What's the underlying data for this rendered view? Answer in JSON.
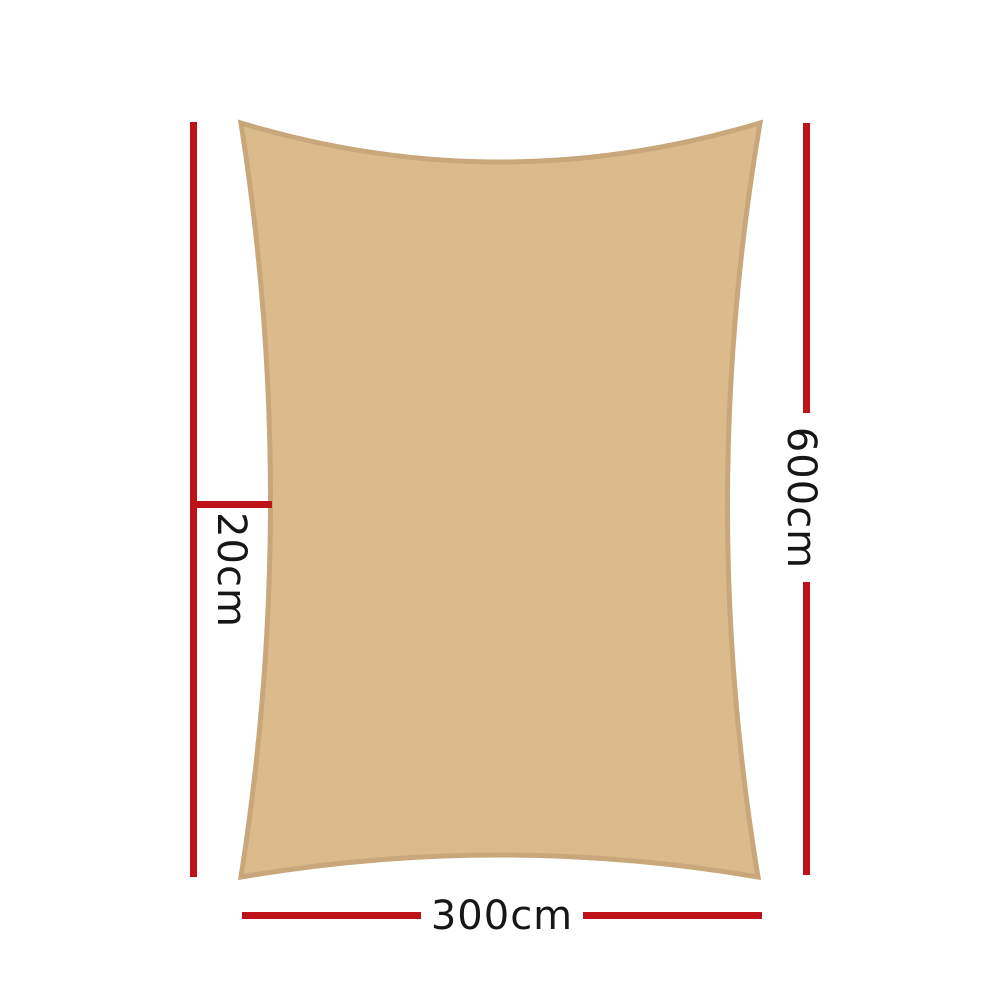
{
  "diagram": {
    "title": "shade-sail-dimension-diagram",
    "shape": "rectangle-shade-sail",
    "labels": {
      "height": "600cm",
      "width": "300cm",
      "curve_depth": "20cm"
    }
  },
  "colors": {
    "page_background": "#ffffff",
    "sail_fill": "#dbbb8c",
    "sail_stroke": "#c8a77a",
    "dimension_line": "#be1218",
    "label_text": "#161616"
  }
}
